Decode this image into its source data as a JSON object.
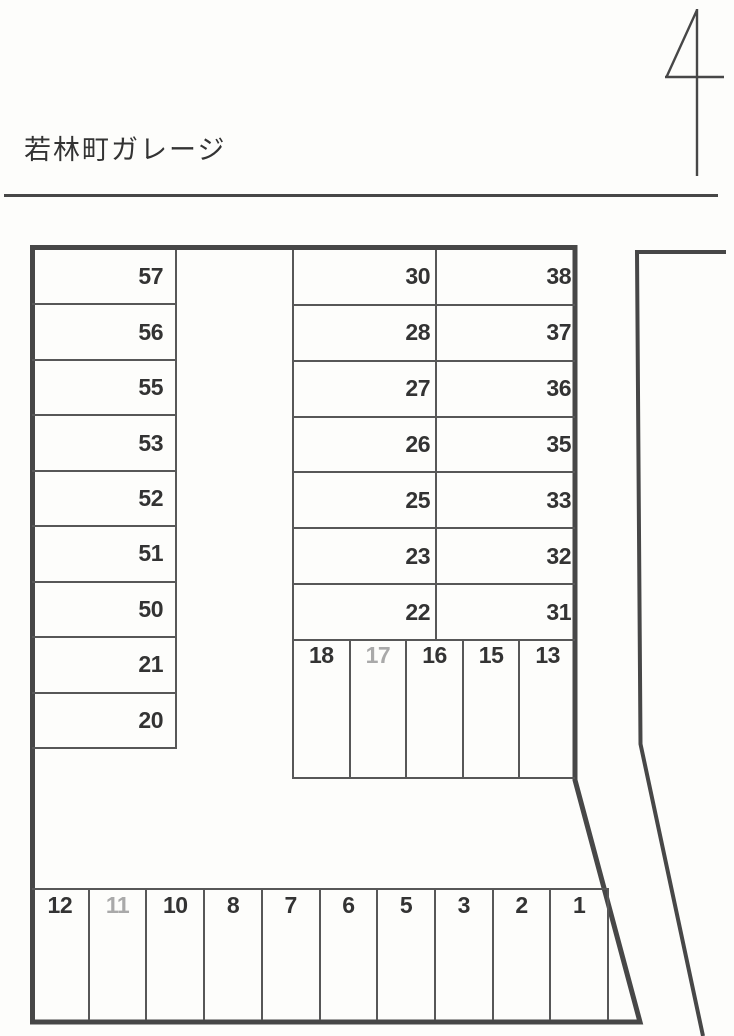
{
  "page": {
    "title": "若林町ガレージ",
    "corner_mark": "4"
  },
  "colors": {
    "paper": "#fdfdfb",
    "boundary": "#474747",
    "grid_line": "#575757",
    "ink": "#333333",
    "faded_ink": "#a9a9a9"
  },
  "lot": {
    "left_column": {
      "stalls": [
        {
          "label": "57"
        },
        {
          "label": "56"
        },
        {
          "label": "55"
        },
        {
          "label": "53"
        },
        {
          "label": "52"
        },
        {
          "label": "51"
        },
        {
          "label": "50"
        },
        {
          "label": "21"
        },
        {
          "label": "20"
        }
      ]
    },
    "middle_column": {
      "stalls": [
        {
          "label": "30"
        },
        {
          "label": "28"
        },
        {
          "label": "27"
        },
        {
          "label": "26"
        },
        {
          "label": "25"
        },
        {
          "label": "23"
        },
        {
          "label": "22"
        }
      ]
    },
    "right_column": {
      "stalls": [
        {
          "label": "38"
        },
        {
          "label": "37"
        },
        {
          "label": "36"
        },
        {
          "label": "35"
        },
        {
          "label": "33"
        },
        {
          "label": "32"
        },
        {
          "label": "31"
        }
      ]
    },
    "middle_row": {
      "stalls": [
        {
          "label": "18"
        },
        {
          "label": "17",
          "state": "faded"
        },
        {
          "label": "16"
        },
        {
          "label": "15"
        },
        {
          "label": "13"
        }
      ]
    },
    "bottom_row": {
      "stalls": [
        {
          "label": "12"
        },
        {
          "label": "11",
          "state": "faded"
        },
        {
          "label": "10"
        },
        {
          "label": "8"
        },
        {
          "label": "7"
        },
        {
          "label": "6"
        },
        {
          "label": "5"
        },
        {
          "label": "3"
        },
        {
          "label": "2"
        },
        {
          "label": "1"
        }
      ]
    }
  }
}
